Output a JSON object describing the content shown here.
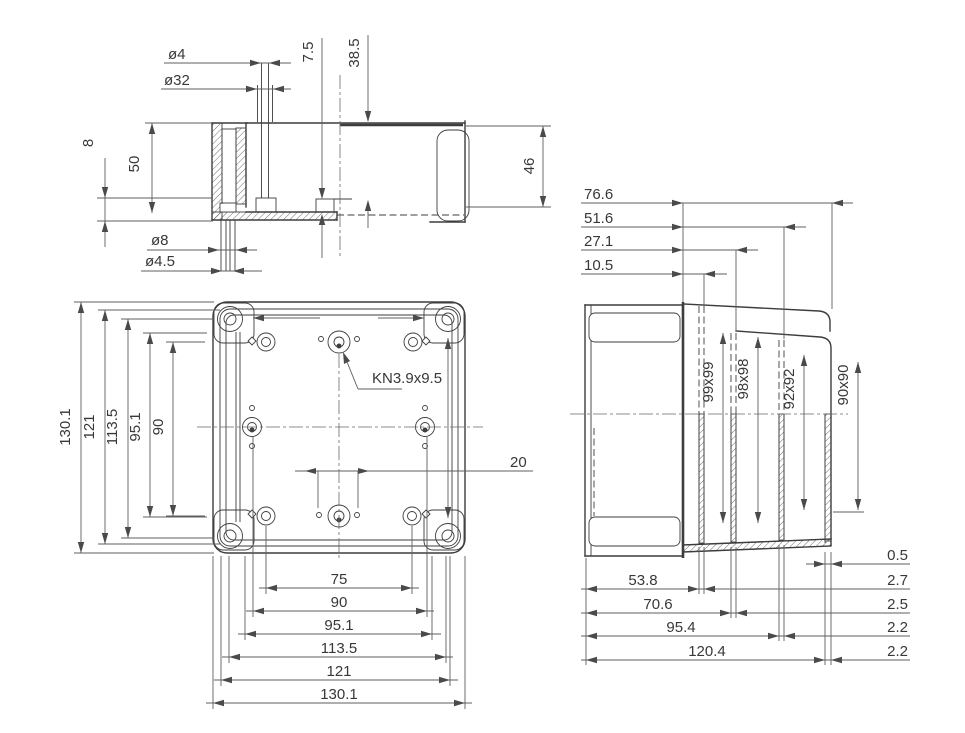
{
  "drawing": {
    "section": {
      "d_phi4": "ø4",
      "d_phi32": "ø32",
      "d_7_5": "7.5",
      "d_38_5": "38.5",
      "d_8": "8",
      "d_50": "50",
      "d_46": "46",
      "d_phi8": "ø8",
      "d_phi45": "ø4.5"
    },
    "plan": {
      "note": "KN3.9x9.5",
      "d20": "20",
      "left": [
        "130.1",
        "121",
        "113.5",
        "95.1",
        "90"
      ],
      "bottom": [
        "75",
        "90",
        "95.1",
        "113.5",
        "121",
        "130.1"
      ]
    },
    "side": {
      "top": [
        "76.6",
        "51.6",
        "27.1",
        "10.5"
      ],
      "bottom": [
        "53.8",
        "70.6",
        "95.4",
        "120.4"
      ],
      "right": [
        "0.5",
        "2.7",
        "2.5",
        "2.2",
        "2.2"
      ],
      "faces": [
        "99x99",
        "98x98",
        "92x92",
        "90x90"
      ]
    },
    "colors": {
      "line": "#3d3d3d",
      "dim": "#5f5f5f",
      "text": "#383838",
      "background": "#ffffff"
    }
  }
}
